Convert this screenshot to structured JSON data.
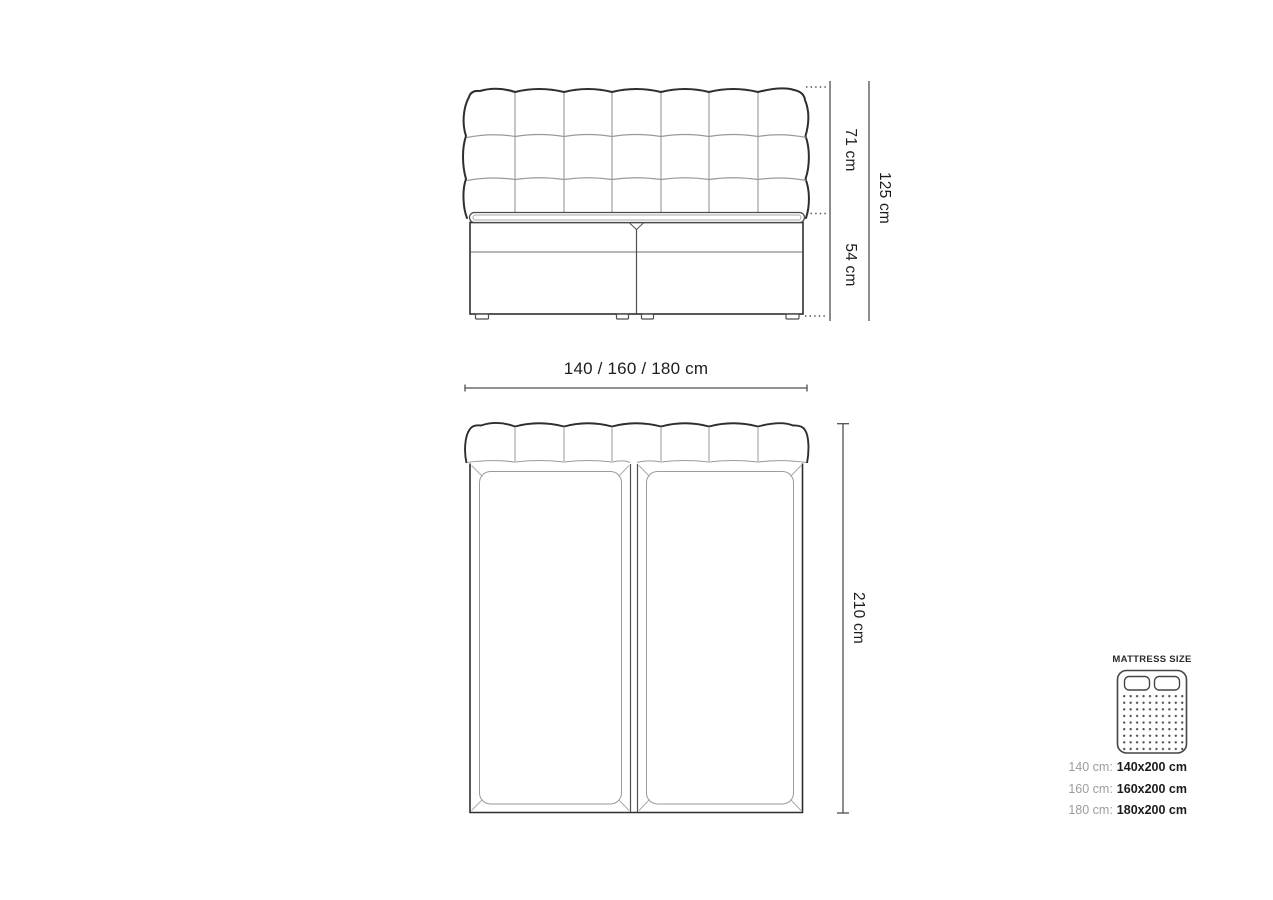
{
  "front_view": {
    "headboard_height": "71 cm",
    "base_height": "54 cm",
    "total_height": "125 cm",
    "width_options": "140 / 160 / 180 cm"
  },
  "top_view": {
    "length": "210 cm"
  },
  "legend": {
    "title": "MATTRESS SIZE",
    "rows": [
      {
        "size": "140 cm:",
        "dimensions": "140x200 cm"
      },
      {
        "size": "160 cm:",
        "dimensions": "160x200 cm"
      },
      {
        "size": "180 cm:",
        "dimensions": "180x200 cm"
      }
    ]
  },
  "colors": {
    "outline": "#2e2e2e",
    "mid": "#4f4f4f",
    "detail": "#9a9a9a",
    "icon": "#454545",
    "legend_gray": "#9c9c9c",
    "text": "#1c1c1c",
    "background": "#ffffff"
  }
}
